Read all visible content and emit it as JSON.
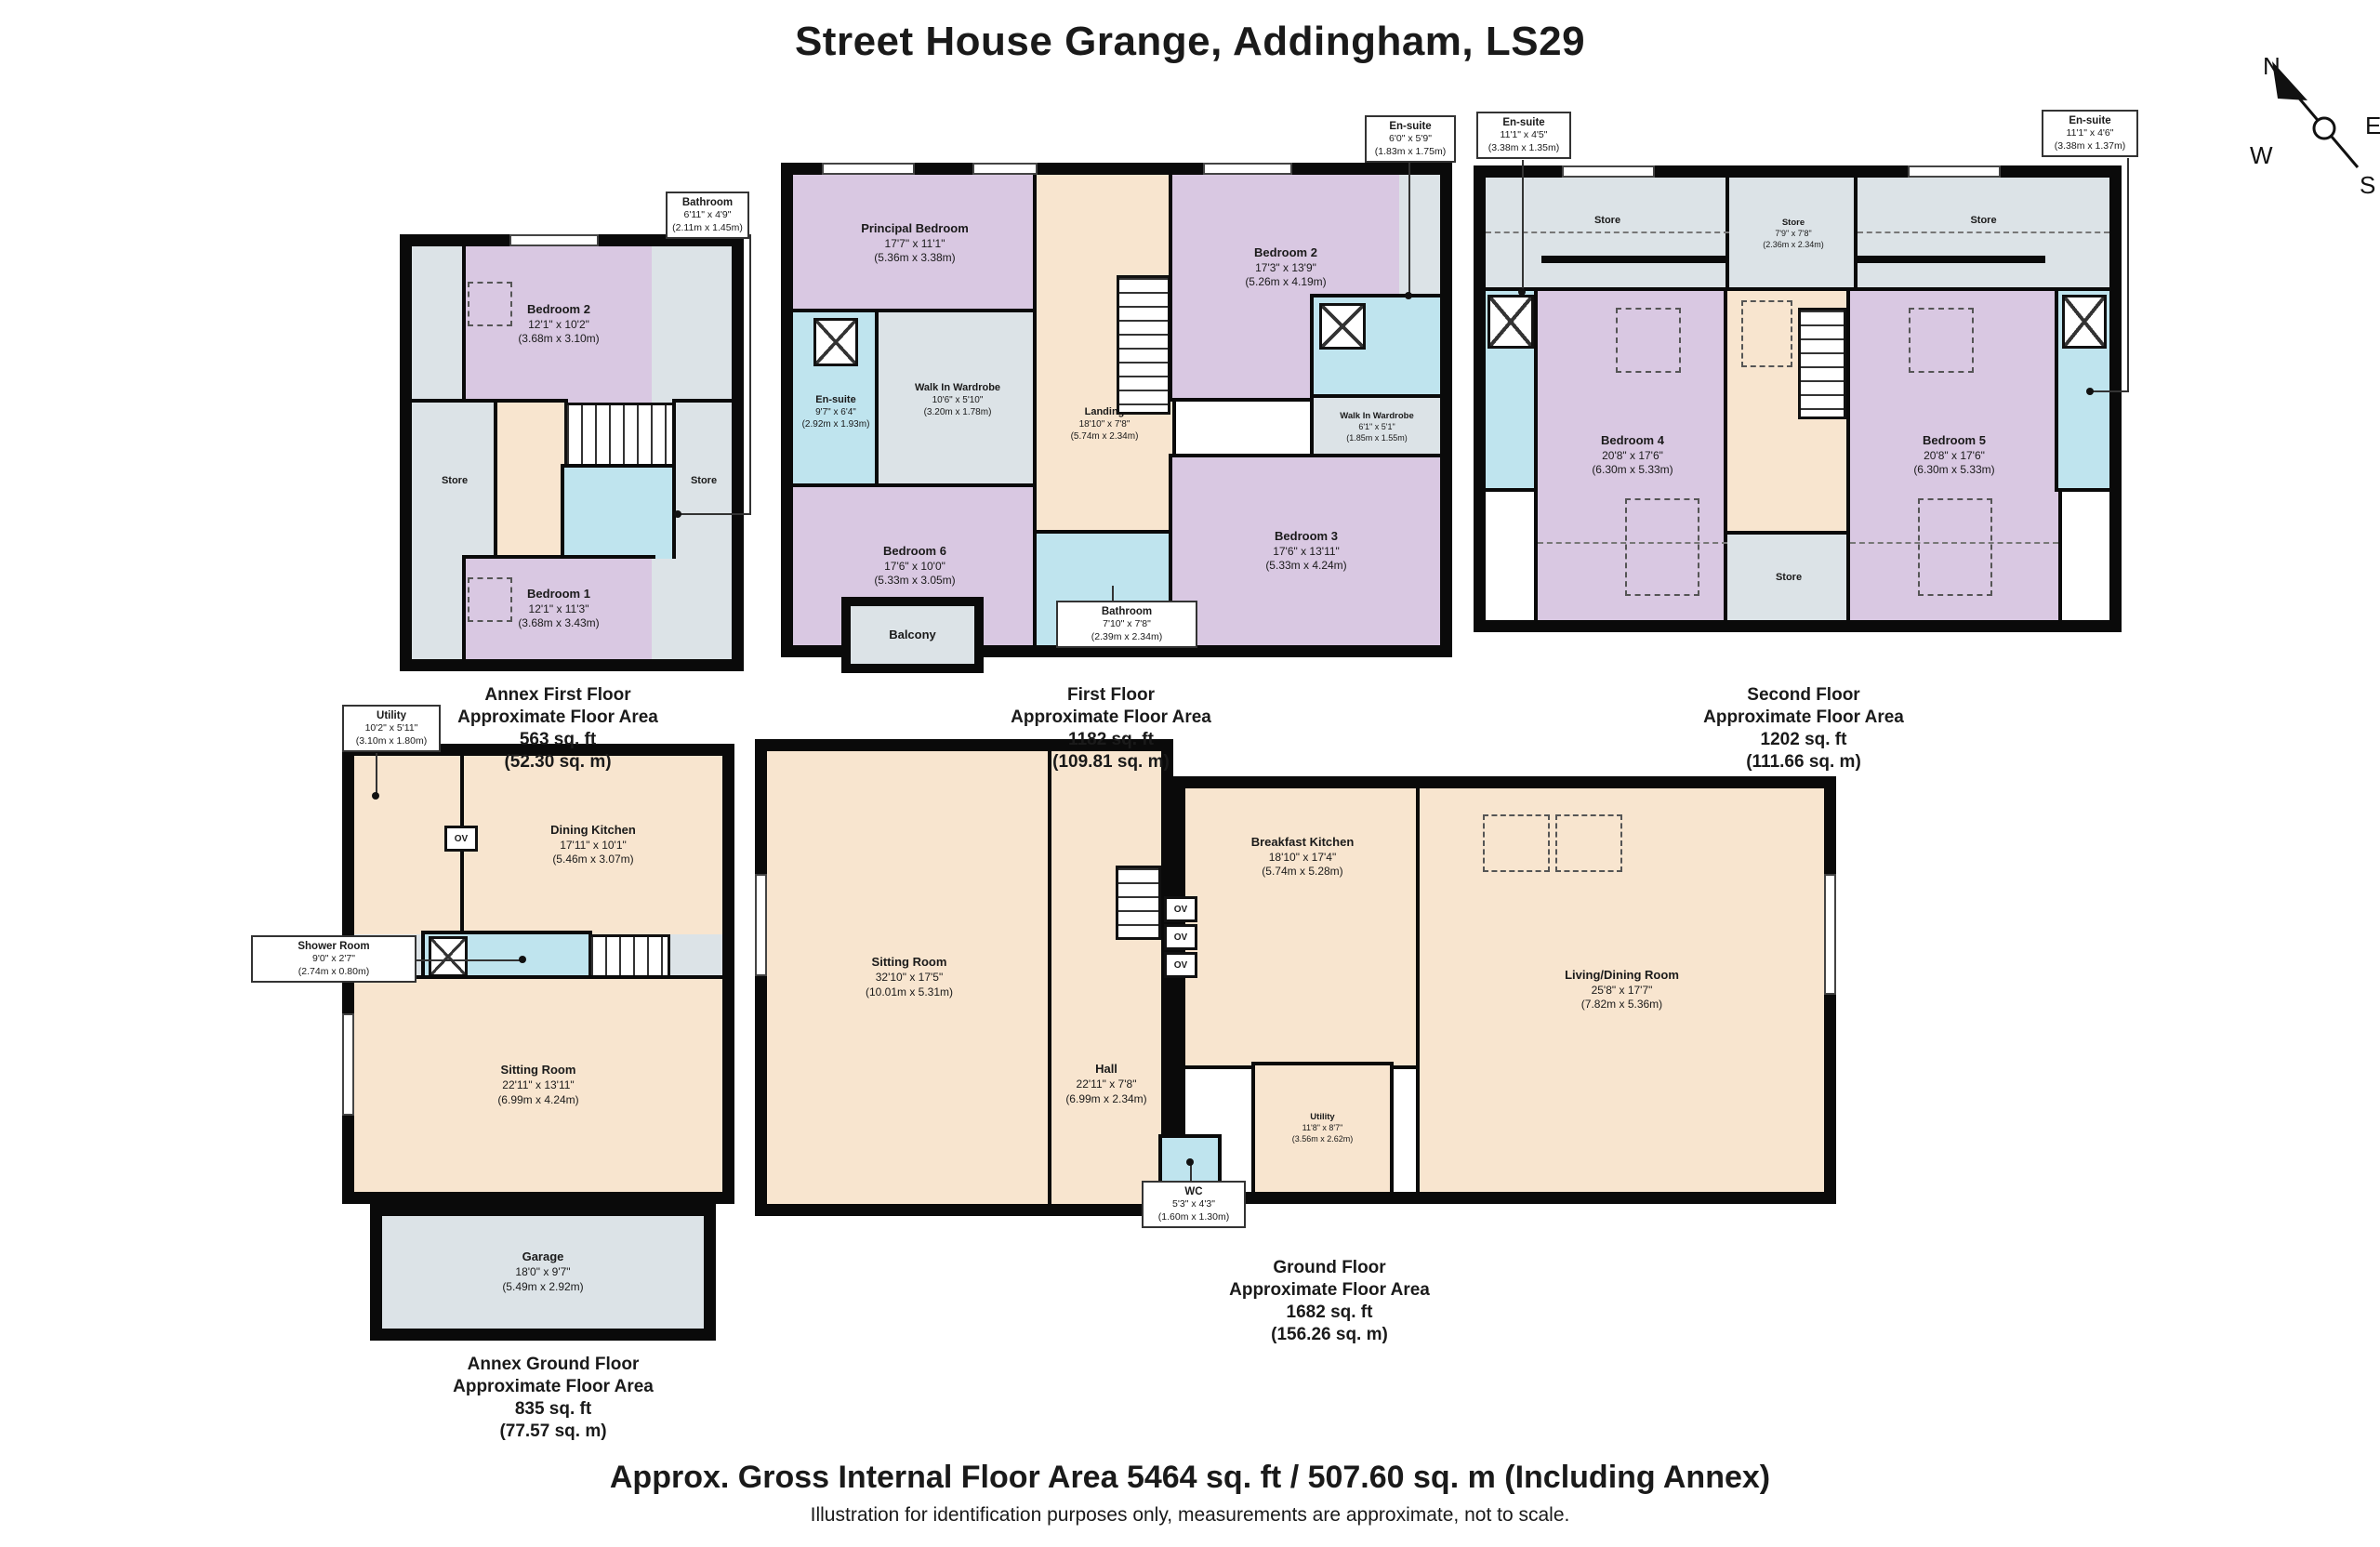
{
  "title": "Street House Grange, Addingham, LS29",
  "compass": {
    "north": "N",
    "east": "E",
    "west": "W",
    "south": "S"
  },
  "floors": {
    "annex_first": {
      "title": "Annex First Floor",
      "subtitle": "Approximate Floor Area",
      "area_ft": "563 sq. ft",
      "area_m": "(52.30 sq. m)"
    },
    "first": {
      "title": "First Floor",
      "subtitle": "Approximate Floor Area",
      "area_ft": "1182 sq. ft",
      "area_m": "(109.81 sq. m)"
    },
    "second": {
      "title": "Second Floor",
      "subtitle": "Approximate Floor Area",
      "area_ft": "1202 sq. ft",
      "area_m": "(111.66 sq. m)"
    },
    "annex_ground": {
      "title": "Annex Ground Floor",
      "subtitle": "Approximate Floor Area",
      "area_ft": "835 sq. ft",
      "area_m": "(77.57 sq. m)"
    },
    "ground": {
      "title": "Ground Floor",
      "subtitle": "Approximate Floor Area",
      "area_ft": "1682 sq. ft",
      "area_m": "(156.26 sq. m)"
    }
  },
  "rooms": {
    "af_bed2": {
      "name": "Bedroom 2",
      "imperial": "12'1\" x 10'2\"",
      "metric": "(3.68m x 3.10m)"
    },
    "af_bed1": {
      "name": "Bedroom 1",
      "imperial": "12'1\" x 11'3\"",
      "metric": "(3.68m x 3.43m)"
    },
    "af_store_l": {
      "name": "Store"
    },
    "af_store_r": {
      "name": "Store"
    },
    "ff_principal": {
      "name": "Principal Bedroom",
      "imperial": "17'7\" x 11'1\"",
      "metric": "(5.36m x 3.38m)"
    },
    "ff_ensuite_l": {
      "name": "En-suite",
      "imperial": "9'7\" x 6'4\"",
      "metric": "(2.92m x 1.93m)"
    },
    "ff_wiw_l": {
      "name": "Walk In Wardrobe",
      "imperial": "10'6\" x 5'10\"",
      "metric": "(3.20m x 1.78m)"
    },
    "ff_landing": {
      "name": "Landing",
      "imperial": "18'10\" x 7'8\"",
      "metric": "(5.74m x 2.34m)"
    },
    "ff_bed2": {
      "name": "Bedroom 2",
      "imperial": "17'3\" x 13'9\"",
      "metric": "(5.26m x 4.19m)"
    },
    "ff_wiw_r": {
      "name": "Walk In Wardrobe",
      "imperial": "6'1\" x 5'1\"",
      "metric": "(1.85m x 1.55m)"
    },
    "ff_bed3": {
      "name": "Bedroom 3",
      "imperial": "17'6\" x 13'11\"",
      "metric": "(5.33m x 4.24m)"
    },
    "ff_bed6": {
      "name": "Bedroom 6",
      "imperial": "17'6\" x 10'0\"",
      "metric": "(5.33m x 3.05m)"
    },
    "ff_balcony": {
      "name": "Balcony"
    },
    "sf_store_l": {
      "name": "Store"
    },
    "sf_store_c": {
      "name": "Store",
      "imperial": "7'9\" x 7'8\"",
      "metric": "(2.36m x 2.34m)"
    },
    "sf_store_r": {
      "name": "Store"
    },
    "sf_store_b": {
      "name": "Store"
    },
    "sf_bed4": {
      "name": "Bedroom 4",
      "imperial": "20'8\" x 17'6\"",
      "metric": "(6.30m x 5.33m)"
    },
    "sf_bed5": {
      "name": "Bedroom 5",
      "imperial": "20'8\" x 17'6\"",
      "metric": "(6.30m x 5.33m)"
    },
    "ag_kitchen": {
      "name": "Dining Kitchen",
      "imperial": "17'11\" x 10'1\"",
      "metric": "(5.46m x 3.07m)"
    },
    "ag_sitting": {
      "name": "Sitting Room",
      "imperial": "22'11\" x 13'11\"",
      "metric": "(6.99m x 4.24m)"
    },
    "ag_garage": {
      "name": "Garage",
      "imperial": "18'0\" x 9'7\"",
      "metric": "(5.49m x 2.92m)"
    },
    "gf_sitting": {
      "name": "Sitting Room",
      "imperial": "32'10\" x 17'5\"",
      "metric": "(10.01m x 5.31m)"
    },
    "gf_hall": {
      "name": "Hall",
      "imperial": "22'11\" x 7'8\"",
      "metric": "(6.99m x 2.34m)"
    },
    "gf_kitchen": {
      "name": "Breakfast Kitchen",
      "imperial": "18'10\" x 17'4\"",
      "metric": "(5.74m x 5.28m)"
    },
    "gf_living": {
      "name": "Living/Dining Room",
      "imperial": "25'8\" x 17'7\"",
      "metric": "(7.82m x 5.36m)"
    },
    "gf_utility": {
      "name": "Utility",
      "imperial": "11'8\" x 8'7\"",
      "metric": "(3.56m x 2.62m)"
    }
  },
  "callouts": {
    "af_bathroom": {
      "name": "Bathroom",
      "imperial": "6'11\" x 4'9\"",
      "metric": "(2.11m x 1.45m)"
    },
    "ff_ensuite_top": {
      "name": "En-suite",
      "imperial": "6'0\" x 5'9\"",
      "metric": "(1.83m x 1.75m)"
    },
    "ff_bathroom": {
      "name": "Bathroom",
      "imperial": "7'10\" x 7'8\"",
      "metric": "(2.39m x 2.34m)"
    },
    "sf_ensuite_l": {
      "name": "En-suite",
      "imperial": "11'1\" x 4'5\"",
      "metric": "(3.38m x 1.35m)"
    },
    "sf_ensuite_r": {
      "name": "En-suite",
      "imperial": "11'1\" x 4'6\"",
      "metric": "(3.38m x 1.37m)"
    },
    "ag_utility": {
      "name": "Utility",
      "imperial": "10'2\" x 5'11\"",
      "metric": "(3.10m x 1.80m)"
    },
    "ag_shower": {
      "name": "Shower Room",
      "imperial": "9'0\" x 2'7\"",
      "metric": "(2.74m x 0.80m)"
    },
    "gf_wc": {
      "name": "WC",
      "imperial": "5'3\" x 4'3\"",
      "metric": "(1.60m x 1.30m)"
    }
  },
  "labels": {
    "ov": "OV"
  },
  "footer": {
    "line1": "Approx. Gross Internal Floor Area 5464 sq. ft / 507.60 sq. m (Including Annex)",
    "line2": "Illustration for identification purposes only, measurements are approximate, not to scale."
  },
  "colors": {
    "bedroom": "#d9c8e2",
    "bathroom": "#bfe4ee",
    "hall": "#f8e5cf",
    "store": "#dce3e7",
    "wall": "#0a0a0a"
  }
}
